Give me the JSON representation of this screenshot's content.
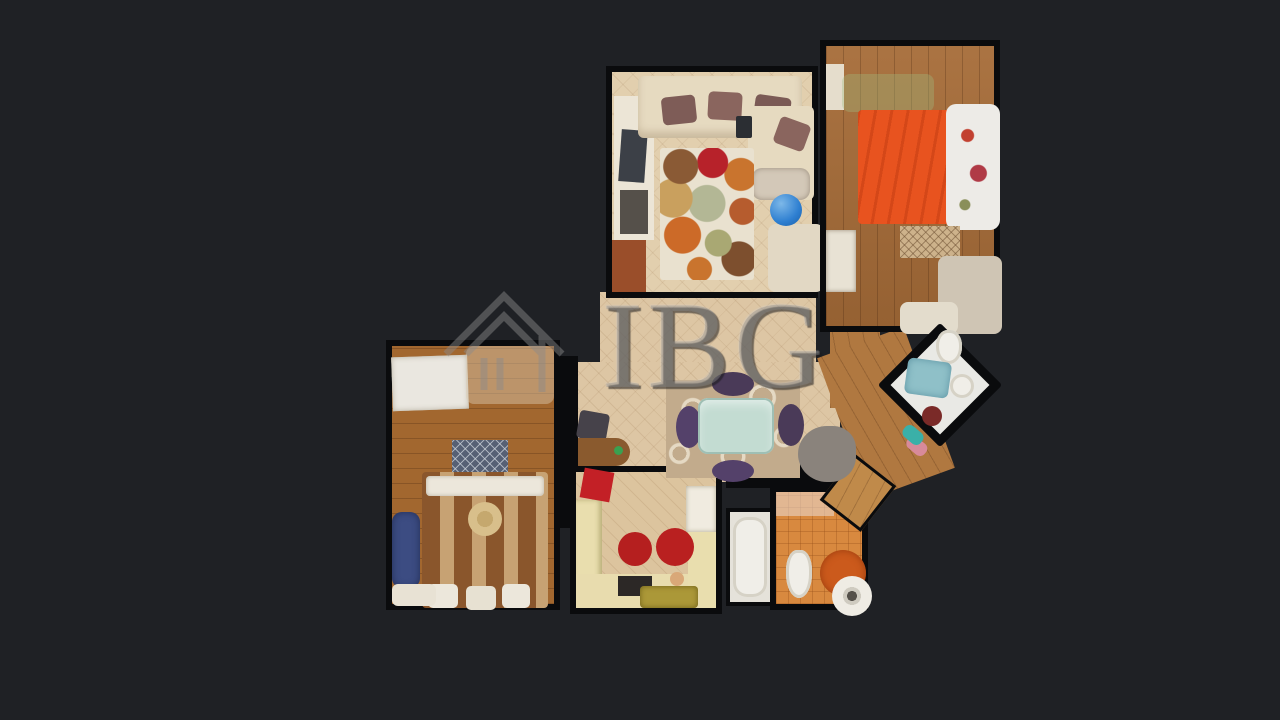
{
  "image": {
    "type": "3d-dollhouse-floorplan-scan",
    "description": "Top-down textured 3D scan of an apartment on a dark background with agency watermark"
  },
  "watermark": {
    "text": "IBG",
    "logo": "house-outline-icon",
    "color": "#8a8a8a"
  },
  "theme": {
    "background": "#1f2125",
    "wall": "#0a0b0d",
    "tile_floor": "#ddc6a4",
    "wood_floor": "#a66c38",
    "orange_bed": "#e8531f",
    "accent_red": "#b51f1f",
    "kitchen_counter": "#e9deae",
    "bath_tile": "#d8893f",
    "teal_towel": "#8fc0c8",
    "purple_chair": "#54416a",
    "glass_table": "#c3dcd2",
    "watermark_gray": "#8a8a8a"
  },
  "scene": {
    "rooms": [
      {
        "name": "living-room",
        "floor": "beige-tile",
        "furniture": [
          "corner-sofa-cream",
          "mauve-pillows",
          "circle-pattern-rug",
          "armchair",
          "blue-exercise-ball",
          "tv-shelf"
        ]
      },
      {
        "name": "bedroom-main",
        "floor": "wood",
        "furniture": [
          "double-bed-orange",
          "white-floral-duvet",
          "diamond-pattern-rug",
          "nightstand",
          "clutter-piles"
        ]
      },
      {
        "name": "hallway-dining",
        "floor": "beige-tile",
        "furniture": [
          "glass-dining-table",
          "purple-chairs",
          "swirl-rug",
          "wooden-desk",
          "office-chair",
          "red-chair",
          "clothes-pile"
        ]
      },
      {
        "name": "bathroom-ensuite",
        "floor": "white",
        "orientation": "diagonal",
        "furniture": [
          "bathtub-with-teal-towels",
          "toilet",
          "sink",
          "red-bucket"
        ]
      },
      {
        "name": "bedroom-second",
        "floor": "wood",
        "furniture": [
          "double-bed-striped-brown",
          "white-pillows",
          "straw-hat",
          "gray-diamond-rug",
          "white-desk",
          "blue-clothes"
        ]
      },
      {
        "name": "kitchen",
        "floor": "beige-tile",
        "furniture": [
          "u-shaped-counter",
          "fridge",
          "two-red-stools",
          "red-chair",
          "dark-stove",
          "gold-tray"
        ]
      },
      {
        "name": "bathroom-second",
        "floor": "terracotta-tile",
        "furniture": [
          "bathtub",
          "toilet",
          "washing-machine",
          "round-orange-rug",
          "wooden-door"
        ]
      },
      {
        "name": "wood-corridor",
        "floor": "wood",
        "furniture": [
          "slippers"
        ]
      }
    ]
  }
}
